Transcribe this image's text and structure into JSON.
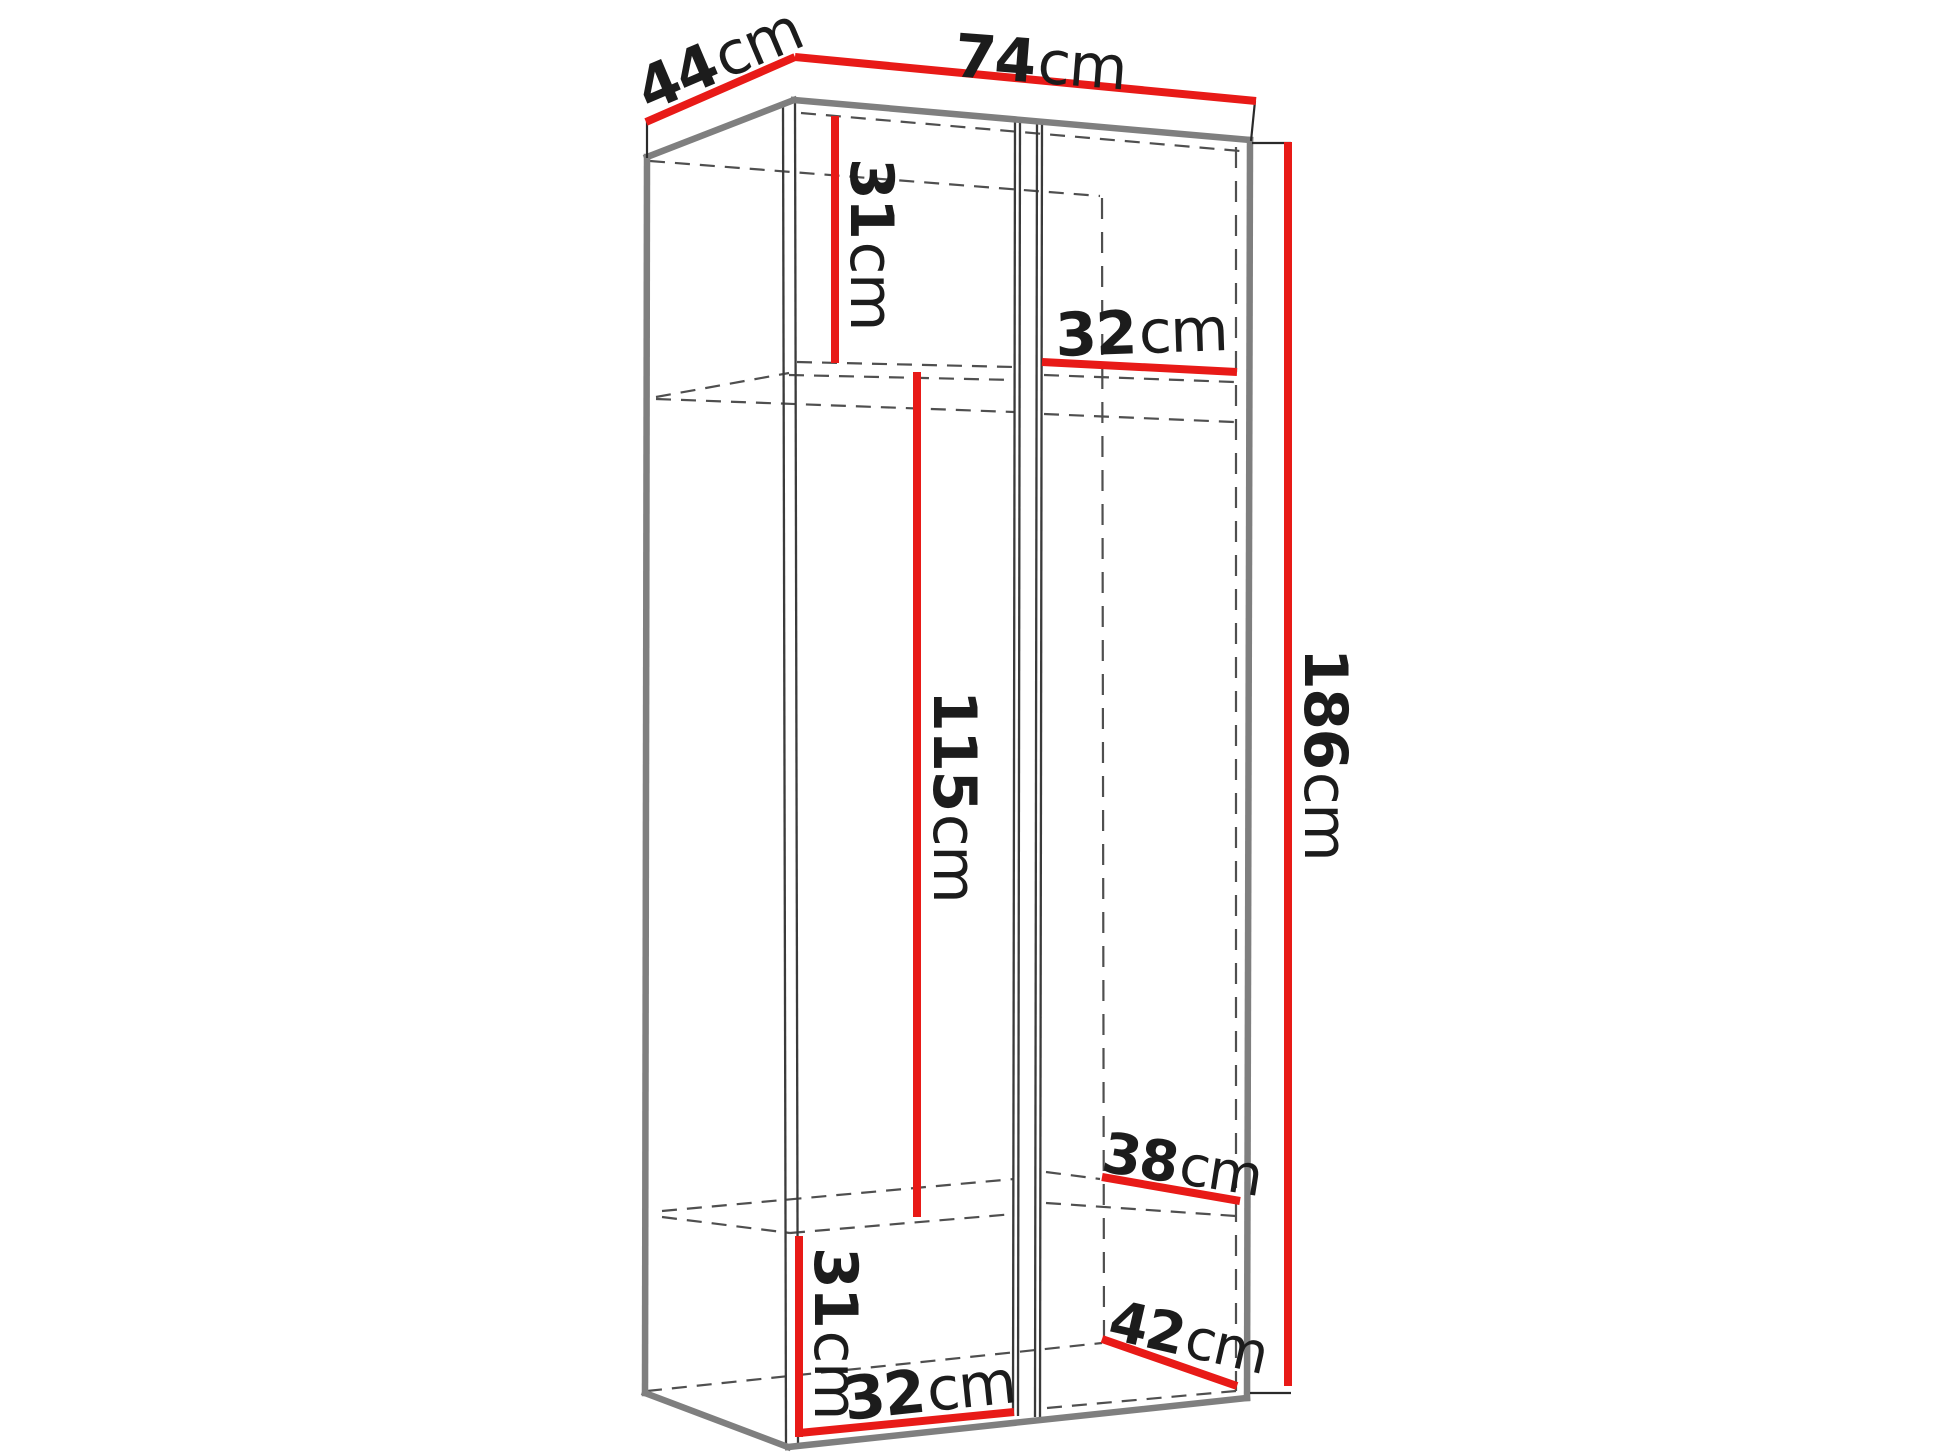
{
  "figure": {
    "type": "furniture-dimension-diagram",
    "subject": "two-section wardrobe shown in perspective with internal shelves"
  },
  "colors": {
    "red": "#e81a17",
    "edge": "#7f7f7f",
    "line": "#3a3a3a",
    "dash": "#4f4f4f",
    "text": "#1c1c1c",
    "background": "#ffffff"
  },
  "dims": {
    "d44": {
      "num": "44",
      "unit": "cm",
      "meaning": "top depth"
    },
    "w74": {
      "num": "74",
      "unit": "cm",
      "meaning": "top width"
    },
    "h31top": {
      "num": "31",
      "unit": "cm",
      "meaning": "upper compartment height"
    },
    "w32top": {
      "num": "32",
      "unit": "cm",
      "meaning": "right compartment width at shelf"
    },
    "h115": {
      "num": "115",
      "unit": "cm",
      "meaning": "middle compartment height"
    },
    "h186": {
      "num": "186",
      "unit": "cm",
      "meaning": "total height"
    },
    "d38": {
      "num": "38",
      "unit": "cm",
      "meaning": "right shelf depth"
    },
    "h31bot": {
      "num": "31",
      "unit": "cm",
      "meaning": "lower compartment height"
    },
    "d42": {
      "num": "42",
      "unit": "cm",
      "meaning": "bottom right depth"
    },
    "w32bot": {
      "num": "32",
      "unit": "cm",
      "meaning": "left compartment width at bottom"
    }
  }
}
